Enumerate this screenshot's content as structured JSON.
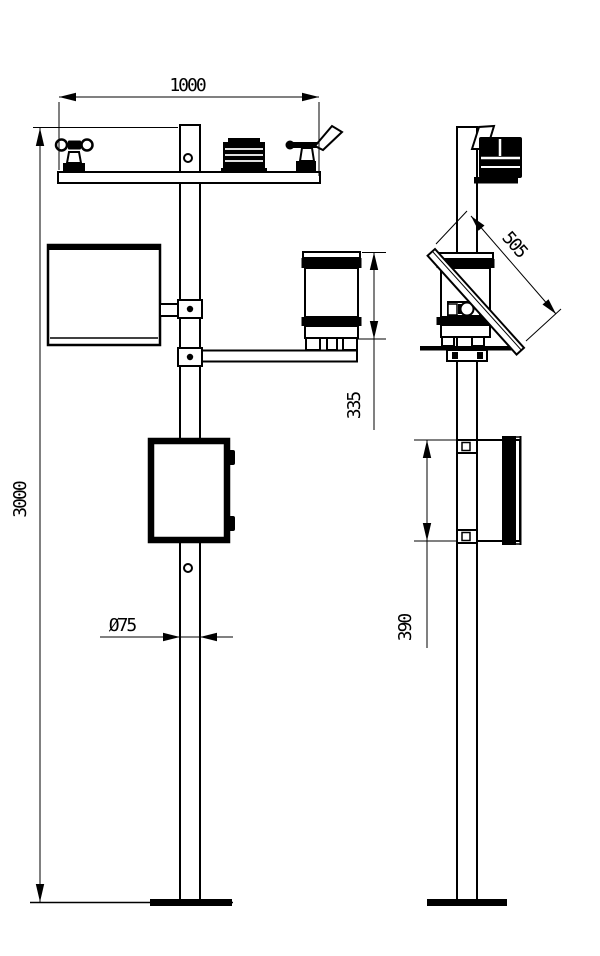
{
  "colors": {
    "ink": "#000000",
    "paper": "#ffffff"
  },
  "drawing": {
    "type": "technical-installation-drawing",
    "subject": "weather-station-pole-two-views"
  },
  "views": {
    "front": {
      "dims": {
        "crossarm_span": "1000",
        "pole_height": "3000",
        "rain_gauge_height": "335",
        "pole_diameter": "Ø75"
      }
    },
    "side": {
      "dims": {
        "solar_panel_length": "505",
        "enclosure_mount_height": "390"
      }
    }
  }
}
